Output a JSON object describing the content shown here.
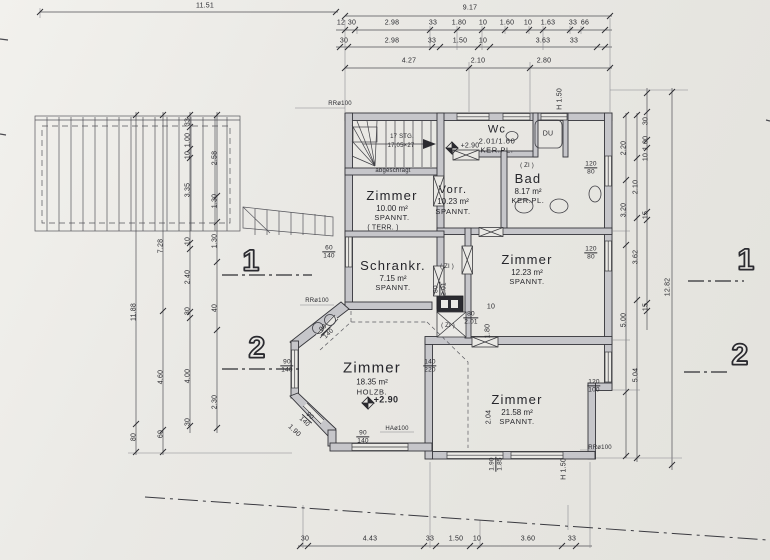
{
  "title": "Grundriss Obergeschoss (floor plan)",
  "colors": {
    "paper": "#eae9e5",
    "ink": "#2e2e33",
    "wall_fill": "#c6c6ca"
  },
  "rooms": [
    {
      "label": "Zimmer",
      "area": "10.00 m²",
      "ceiling": "SPANNT."
    },
    {
      "label": "Vorr.",
      "area": "10.23 m²",
      "ceiling": "SPANNT."
    },
    {
      "label": "Bad",
      "area": "8.17 m²",
      "ceiling": "KER.PL."
    },
    {
      "label": "Wc",
      "area": "2.01/1.60",
      "ceiling": "KER.PL."
    },
    {
      "label": "Zimmer",
      "area": "12.23 m²",
      "ceiling": "SPANNT."
    },
    {
      "label": "Schrankr.",
      "area": "7.15 m²",
      "ceiling": "SPANNT."
    },
    {
      "label": "Zimmer",
      "area": "18.35 m²",
      "ceiling": "HOLZB."
    },
    {
      "label": "Zimmer",
      "area": "21.58 m²",
      "ceiling": "SPANNT."
    }
  ],
  "annotations": [
    {
      "n": "dim-top-total-left",
      "t": "11.51",
      "x": 205,
      "y": 6
    },
    {
      "n": "dim-top-total",
      "t": "9.17",
      "x": 470,
      "y": 8
    },
    {
      "n": "dim-top",
      "t": "12",
      "x": 341,
      "y": 23
    },
    {
      "n": "dim-top",
      "t": "30",
      "x": 352,
      "y": 23
    },
    {
      "n": "dim-top",
      "t": "2.98",
      "x": 392,
      "y": 23
    },
    {
      "n": "dim-top",
      "t": "33",
      "x": 433,
      "y": 23
    },
    {
      "n": "dim-top",
      "t": "1.80",
      "x": 459,
      "y": 23
    },
    {
      "n": "dim-top",
      "t": "10",
      "x": 483,
      "y": 23
    },
    {
      "n": "dim-top",
      "t": "1.60",
      "x": 507,
      "y": 23
    },
    {
      "n": "dim-top",
      "t": "10",
      "x": 528,
      "y": 23
    },
    {
      "n": "dim-top",
      "t": "1.63",
      "x": 548,
      "y": 23
    },
    {
      "n": "dim-top",
      "t": "33",
      "x": 573,
      "y": 23
    },
    {
      "n": "dim-top",
      "t": "66",
      "x": 585,
      "y": 23
    },
    {
      "n": "dim-top",
      "t": "30",
      "x": 344,
      "y": 41
    },
    {
      "n": "dim-top",
      "t": "2.98",
      "x": 392,
      "y": 41
    },
    {
      "n": "dim-top",
      "t": "33",
      "x": 432,
      "y": 41
    },
    {
      "n": "dim-top",
      "t": "1.50",
      "x": 460,
      "y": 41
    },
    {
      "n": "dim-top",
      "t": "10",
      "x": 483,
      "y": 41
    },
    {
      "n": "dim-top",
      "t": "3.63",
      "x": 543,
      "y": 41
    },
    {
      "n": "dim-top",
      "t": "33",
      "x": 574,
      "y": 41
    },
    {
      "n": "dim-top",
      "t": "4.27",
      "x": 409,
      "y": 61
    },
    {
      "n": "dim-top",
      "t": "2.10",
      "x": 478,
      "y": 61
    },
    {
      "n": "dim-top",
      "t": "2.80",
      "x": 544,
      "y": 61
    },
    {
      "n": "dim-bottom",
      "t": "30",
      "x": 305,
      "y": 539
    },
    {
      "n": "dim-bottom",
      "t": "4.43",
      "x": 370,
      "y": 539
    },
    {
      "n": "dim-bottom",
      "t": "33",
      "x": 430,
      "y": 539
    },
    {
      "n": "dim-bottom",
      "t": "1.50",
      "x": 456,
      "y": 539
    },
    {
      "n": "dim-bottom",
      "t": "10",
      "x": 477,
      "y": 539
    },
    {
      "n": "dim-bottom",
      "t": "3.60",
      "x": 528,
      "y": 539
    },
    {
      "n": "dim-bottom",
      "t": "33",
      "x": 572,
      "y": 539
    },
    {
      "n": "dim-left",
      "t": "11.88",
      "x": 134,
      "y": 312,
      "r": -90
    },
    {
      "n": "dim-left",
      "t": "80",
      "x": 134,
      "y": 437,
      "r": -90
    },
    {
      "n": "dim-left",
      "t": "7.28",
      "x": 161,
      "y": 246,
      "r": -90
    },
    {
      "n": "dim-left",
      "t": "4.60",
      "x": 161,
      "y": 377,
      "r": -90
    },
    {
      "n": "dim-left",
      "t": "60",
      "x": 161,
      "y": 434,
      "r": -90
    },
    {
      "n": "dim-left",
      "t": "33",
      "x": 188,
      "y": 122,
      "r": -90
    },
    {
      "n": "dim-left",
      "t": "1.00",
      "x": 188,
      "y": 140,
      "r": -90
    },
    {
      "n": "dim-left",
      "t": "10",
      "x": 188,
      "y": 155,
      "r": -90
    },
    {
      "n": "dim-left",
      "t": "3.35",
      "x": 188,
      "y": 190,
      "r": -90
    },
    {
      "n": "dim-left",
      "t": "10",
      "x": 188,
      "y": 241,
      "r": -90
    },
    {
      "n": "dim-left",
      "t": "2.40",
      "x": 188,
      "y": 277,
      "r": -90
    },
    {
      "n": "dim-left",
      "t": "30",
      "x": 188,
      "y": 311,
      "r": -90
    },
    {
      "n": "dim-left",
      "t": "4.00",
      "x": 188,
      "y": 376,
      "r": -90
    },
    {
      "n": "dim-left",
      "t": "30",
      "x": 188,
      "y": 422,
      "r": -90
    },
    {
      "n": "dim-left",
      "t": "2.58",
      "x": 215,
      "y": 158,
      "r": -90
    },
    {
      "n": "dim-left",
      "t": "1.30",
      "x": 215,
      "y": 201,
      "r": -90
    },
    {
      "n": "dim-left",
      "t": "1.30",
      "x": 215,
      "y": 241,
      "r": -90
    },
    {
      "n": "dim-left",
      "t": "40",
      "x": 215,
      "y": 308,
      "r": -90
    },
    {
      "n": "dim-left",
      "t": "2.30",
      "x": 215,
      "y": 402,
      "r": -90
    },
    {
      "n": "dim-right",
      "t": "2.20",
      "x": 624,
      "y": 148,
      "r": -90
    },
    {
      "n": "dim-right",
      "t": "3.20",
      "x": 624,
      "y": 210,
      "r": -90
    },
    {
      "n": "dim-right",
      "t": "5.00",
      "x": 624,
      "y": 320,
      "r": -90
    },
    {
      "n": "dim-right",
      "t": "2.10",
      "x": 636,
      "y": 187,
      "r": -90
    },
    {
      "n": "dim-right",
      "t": "3.62",
      "x": 636,
      "y": 257,
      "r": -90
    },
    {
      "n": "dim-right",
      "t": "5.04",
      "x": 636,
      "y": 375,
      "r": -90
    },
    {
      "n": "dim-right",
      "t": "30",
      "x": 646,
      "y": 121,
      "r": -90
    },
    {
      "n": "dim-right",
      "t": "1.00",
      "x": 646,
      "y": 143,
      "r": -90
    },
    {
      "n": "dim-right",
      "t": "10",
      "x": 646,
      "y": 157,
      "r": -90
    },
    {
      "n": "dim-right",
      "t": "15",
      "x": 646,
      "y": 215,
      "r": -90
    },
    {
      "n": "dim-right",
      "t": "15",
      "x": 646,
      "y": 307,
      "r": -90
    },
    {
      "n": "dim-right-total",
      "t": "12.82",
      "x": 668,
      "y": 287,
      "r": -90
    },
    {
      "n": "dim-room",
      "t": "2.04",
      "x": 489,
      "y": 417,
      "r": -90
    },
    {
      "n": "dim-room",
      "t": "1.80",
      "x": 488,
      "y": 331,
      "r": -90
    },
    {
      "n": "dim-room",
      "t": "10",
      "x": 491,
      "y": 307
    },
    {
      "n": "dim-room",
      "t": "1.90",
      "x": 294,
      "y": 431,
      "r": 43
    },
    {
      "n": "note-height",
      "t": "H 1.50",
      "x": 560,
      "y": 99,
      "r": -90
    },
    {
      "n": "note-height",
      "t": "H 1.50",
      "x": 564,
      "y": 469,
      "r": -90
    },
    {
      "n": "window-tag",
      "t": "60/140",
      "x": 329,
      "y": 252,
      "f": true,
      "cls": "frac"
    },
    {
      "n": "window-tag",
      "t": "90/140",
      "x": 287,
      "y": 366,
      "f": true,
      "cls": "frac"
    },
    {
      "n": "window-tag",
      "t": "90/140",
      "x": 363,
      "y": 437,
      "f": true,
      "cls": "frac"
    },
    {
      "n": "window-tag",
      "t": "90/140",
      "x": 326,
      "y": 331,
      "r": -43,
      "f": true,
      "cls": "frac"
    },
    {
      "n": "window-tag",
      "t": "90/140",
      "x": 307,
      "y": 419,
      "r": 43,
      "f": true,
      "cls": "frac"
    },
    {
      "n": "window-tag",
      "t": "140/220",
      "x": 430,
      "y": 366,
      "f": true,
      "cls": "frac"
    },
    {
      "n": "window-tag",
      "t": "120/80",
      "x": 591,
      "y": 168,
      "f": true,
      "cls": "frac"
    },
    {
      "n": "window-tag",
      "t": "120/80",
      "x": 591,
      "y": 253,
      "f": true,
      "cls": "frac"
    },
    {
      "n": "window-tag",
      "t": "120/100",
      "x": 594,
      "y": 386,
      "f": true,
      "cls": "frac"
    },
    {
      "n": "door-tag",
      "t": "80/2.01",
      "x": 440,
      "y": 289,
      "r": -90,
      "f": true,
      "cls": "frac"
    },
    {
      "n": "door-tag",
      "t": "80/2.01",
      "x": 471,
      "y": 318,
      "f": true,
      "cls": "frac"
    },
    {
      "n": "dim-room",
      "t": "1.90/1.85",
      "x": 496,
      "y": 464,
      "r": -90,
      "f": true,
      "cls": "frac"
    },
    {
      "n": "pipe-note",
      "t": "RRø100",
      "x": 340,
      "y": 104,
      "cls": "s6"
    },
    {
      "n": "pipe-note",
      "t": "RRø100",
      "x": 317,
      "y": 301,
      "cls": "s6"
    },
    {
      "n": "pipe-note",
      "t": "RRø100",
      "x": 600,
      "y": 448,
      "cls": "s6"
    },
    {
      "n": "pipe-note",
      "t": "HAø100",
      "x": 397,
      "y": 429,
      "cls": "s6"
    },
    {
      "n": "zi-note",
      "t": "( ZI )",
      "x": 527,
      "y": 166,
      "cls": "s6"
    },
    {
      "n": "zi-note",
      "t": "( ZI )",
      "x": 447,
      "y": 267,
      "cls": "s6"
    },
    {
      "n": "zi-note",
      "t": "( ZI )",
      "x": 448,
      "y": 326,
      "cls": "s6"
    },
    {
      "n": "level-marker-label",
      "t": "+2.90",
      "x": 470,
      "y": 146,
      "cls": "s7"
    },
    {
      "n": "level-marker-label",
      "t": "+2.90",
      "x": 386,
      "y": 400,
      "cls": "big"
    },
    {
      "n": "stairs-note",
      "t": "17 STG.",
      "x": 402,
      "y": 137,
      "cls": "s6"
    },
    {
      "n": "stairs-note",
      "t": "17,05×27",
      "x": 401,
      "y": 146,
      "cls": "s6"
    },
    {
      "n": "ceiling-note",
      "t": "abgeschrägt",
      "x": 393,
      "y": 171,
      "cls": "s6"
    },
    {
      "n": "shower-label",
      "t": "DU",
      "x": 548,
      "y": 134,
      "cls": "s7"
    },
    {
      "n": "terrace-note",
      "t": "( TERR. )",
      "x": 383,
      "y": 228,
      "cls": "s7"
    },
    {
      "n": "section-marker",
      "t": "1",
      "x": 251,
      "y": 261,
      "cls": "sec"
    },
    {
      "n": "section-marker",
      "t": "2",
      "x": 257,
      "y": 348,
      "cls": "sec"
    },
    {
      "n": "section-marker",
      "t": "1",
      "x": 746,
      "y": 260,
      "cls": "sec"
    },
    {
      "n": "section-marker",
      "t": "2",
      "x": 740,
      "y": 355,
      "cls": "sec"
    }
  ]
}
